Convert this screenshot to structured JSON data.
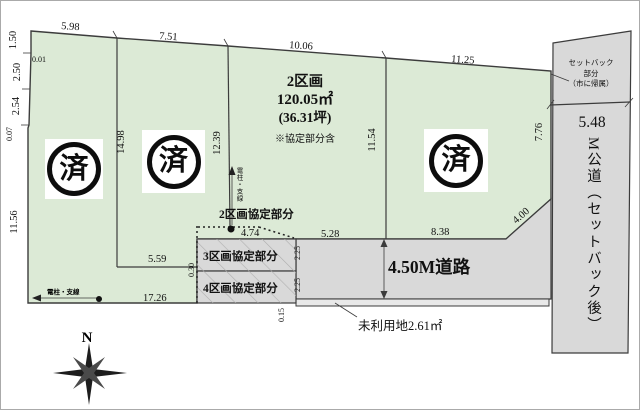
{
  "colors": {
    "lot_green": "#dcead6",
    "road_gray": "#d9d9d9",
    "strip_gray": "#e9e9e9",
    "hatch_gray": "#aeaeae",
    "line_dark": "#3c3c3c",
    "stamp_black": "#0d0d0d"
  },
  "lot2": {
    "name": "2区画",
    "area_m2": "120.05㎡",
    "area_tsubo": "(36.31坪)",
    "note": "※協定部分含"
  },
  "stamps": {
    "sold_label": "済"
  },
  "agreement_labels": {
    "lot2": "2区画協定部分",
    "lot3": "3区画協定部分",
    "lot4": "4区画協定部分"
  },
  "roads": {
    "south_label": "4.50M道路",
    "east_width": "5.48",
    "east_label_vertical": "M公道（セットバック後）",
    "setback_line1": "セットバック",
    "setback_line2": "部分",
    "setback_line3": "（市に帰属）",
    "unused_land": "未利用地2.61㎡"
  },
  "utility": {
    "pole_left": "電柱・支線",
    "pole_center": "電柱・支線"
  },
  "compass": {
    "north_label": "N"
  },
  "dimensions": {
    "top": [
      "5.98",
      "7.51",
      "10.06",
      "11.25"
    ],
    "left": [
      "1.50",
      "0.01",
      "2.50",
      "2.54",
      "0.07",
      "11.56"
    ],
    "vertical": [
      "14.98",
      "12.39",
      "11.54",
      "7.76"
    ],
    "bottom": [
      "4.74",
      "5.28",
      "8.38",
      "4.00",
      "5.59",
      "17.26"
    ],
    "small": [
      "0.30",
      "2.25",
      "2.25",
      "0.15"
    ]
  }
}
